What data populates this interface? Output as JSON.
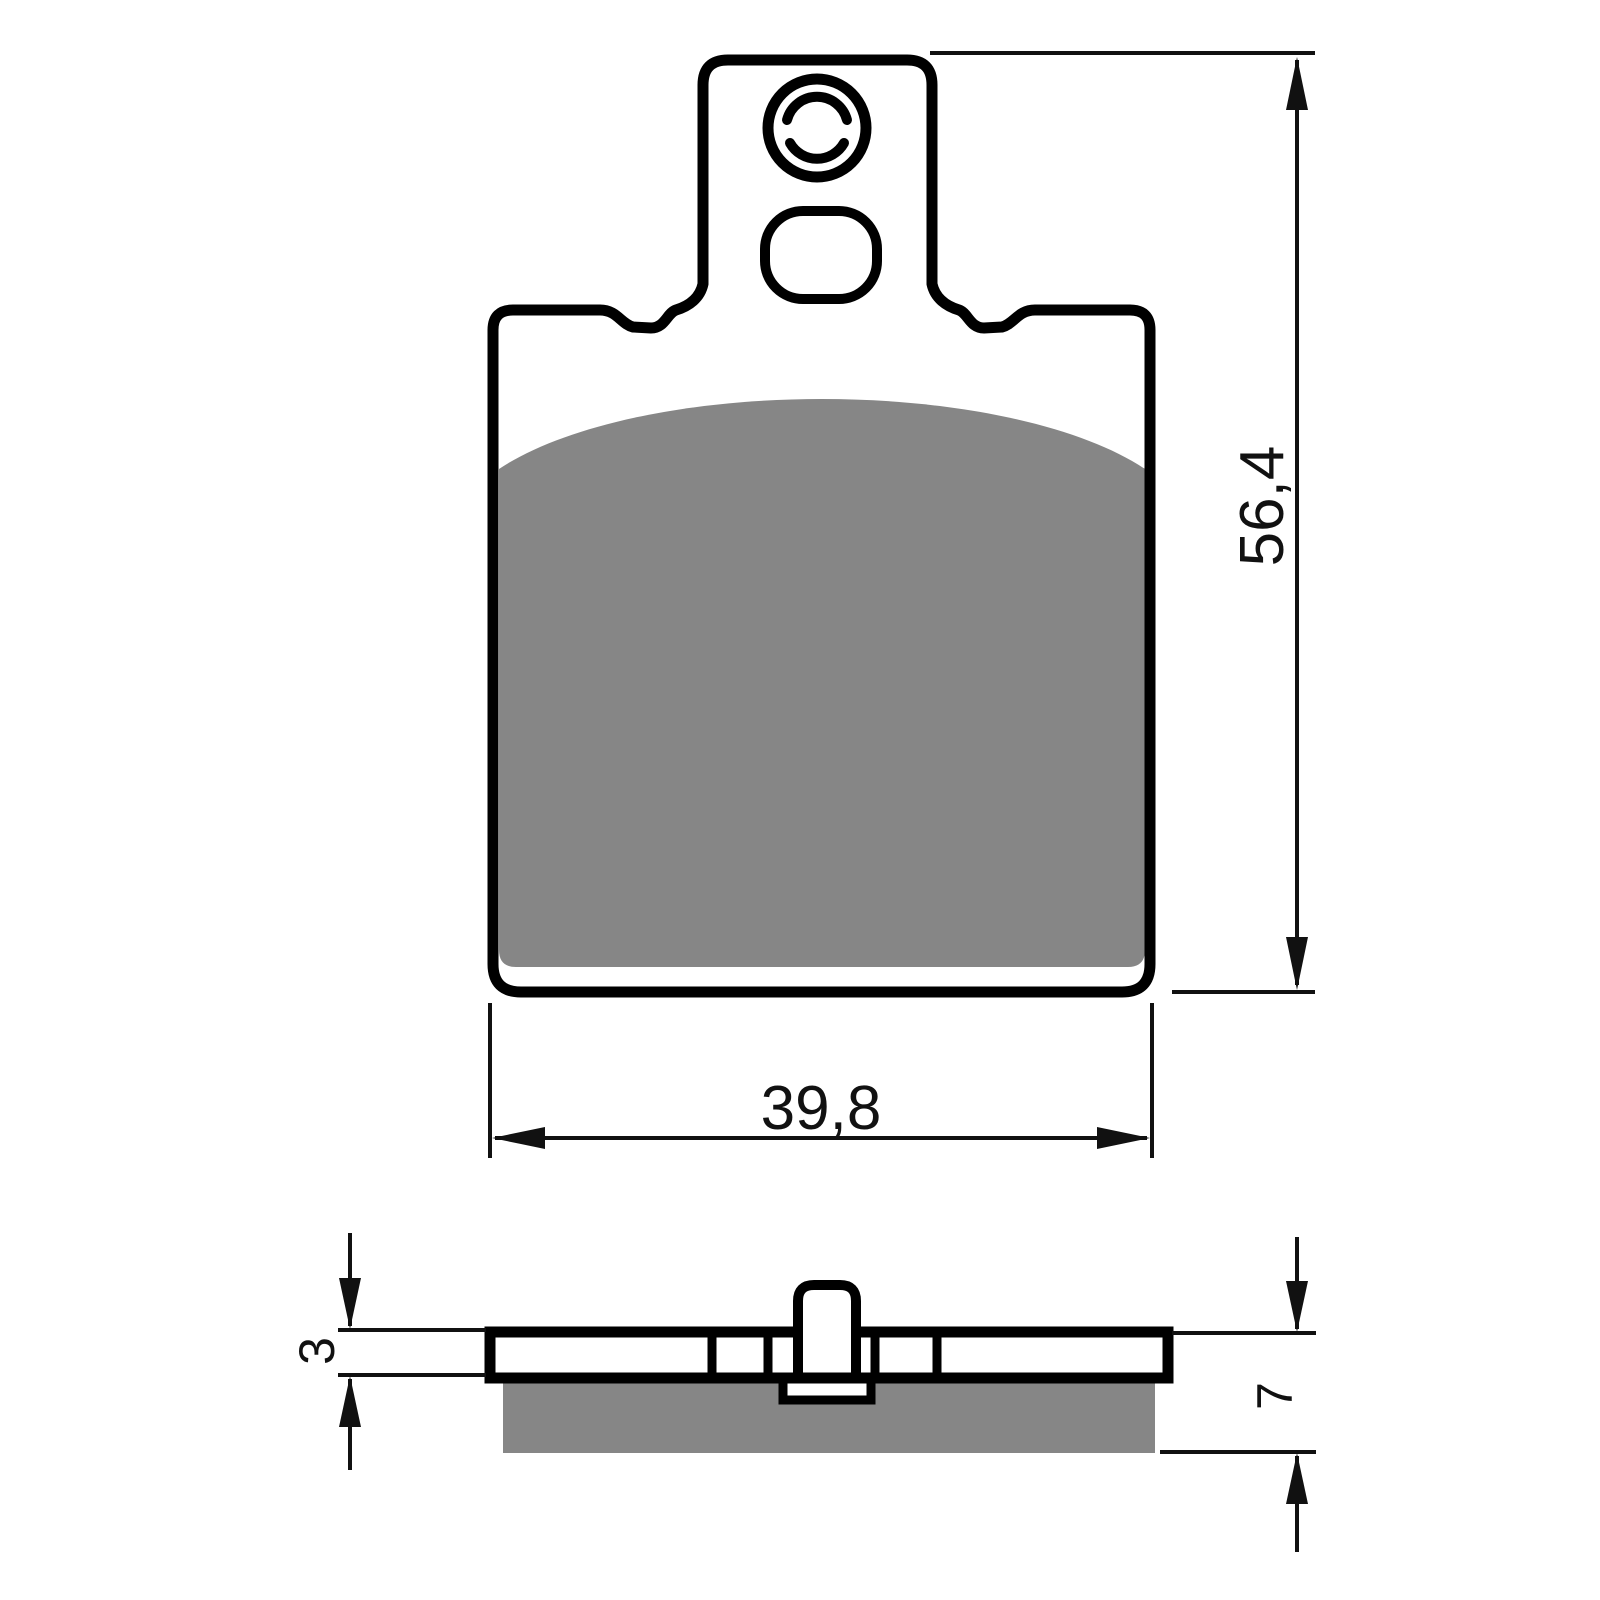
{
  "drawing": {
    "background": "#ffffff",
    "outline_color": "#000000",
    "friction_color": "#868686",
    "dimension_color": "#111111",
    "dimensions": {
      "total_height": "56,4",
      "pad_width": "39,8",
      "plate_thickness": "3",
      "total_thickness": "7"
    }
  }
}
